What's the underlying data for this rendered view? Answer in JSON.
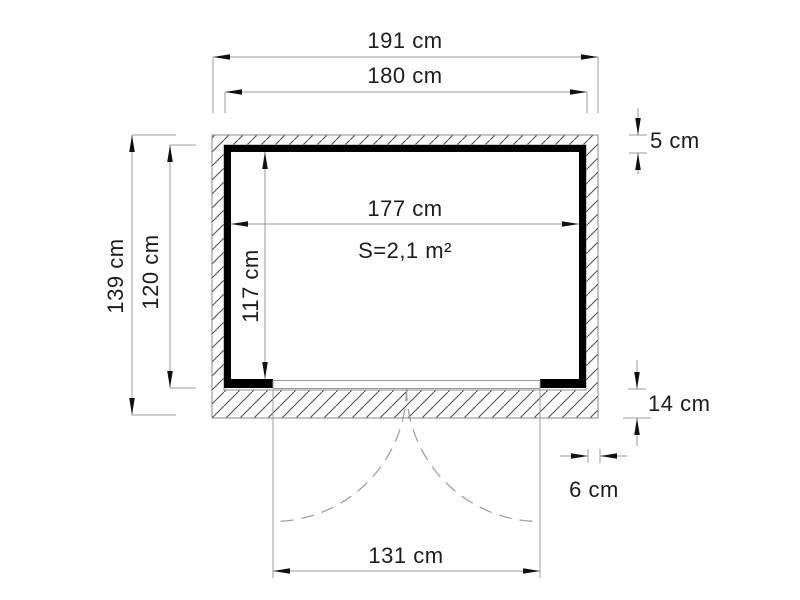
{
  "diagram": {
    "kind": "shed-floor-plan",
    "unit": "cm",
    "area": {
      "label": "S=2,1 m²",
      "value_m2": "2,1"
    },
    "dimensions": [
      {
        "id": "outer-width",
        "label": "191 cm",
        "cm": 191,
        "axis": "horizontal"
      },
      {
        "id": "frame-width",
        "label": "180 cm",
        "cm": 180,
        "axis": "horizontal"
      },
      {
        "id": "interior-width",
        "label": "177 cm",
        "cm": 177,
        "axis": "horizontal"
      },
      {
        "id": "outer-depth",
        "label": "139 cm",
        "cm": 139,
        "axis": "vertical"
      },
      {
        "id": "frame-depth",
        "label": "120 cm",
        "cm": 120,
        "axis": "vertical"
      },
      {
        "id": "interior-depth",
        "label": "117 cm",
        "cm": 117,
        "axis": "vertical"
      },
      {
        "id": "wall-offset-top",
        "label": "5 cm",
        "cm": 5,
        "axis": "vertical"
      },
      {
        "id": "base-depth",
        "label": "14 cm",
        "cm": 14,
        "axis": "vertical"
      },
      {
        "id": "wall-offset-side",
        "label": "6 cm",
        "cm": 6,
        "axis": "horizontal"
      },
      {
        "id": "door-width",
        "label": "131 cm",
        "cm": 131,
        "axis": "horizontal"
      }
    ]
  }
}
